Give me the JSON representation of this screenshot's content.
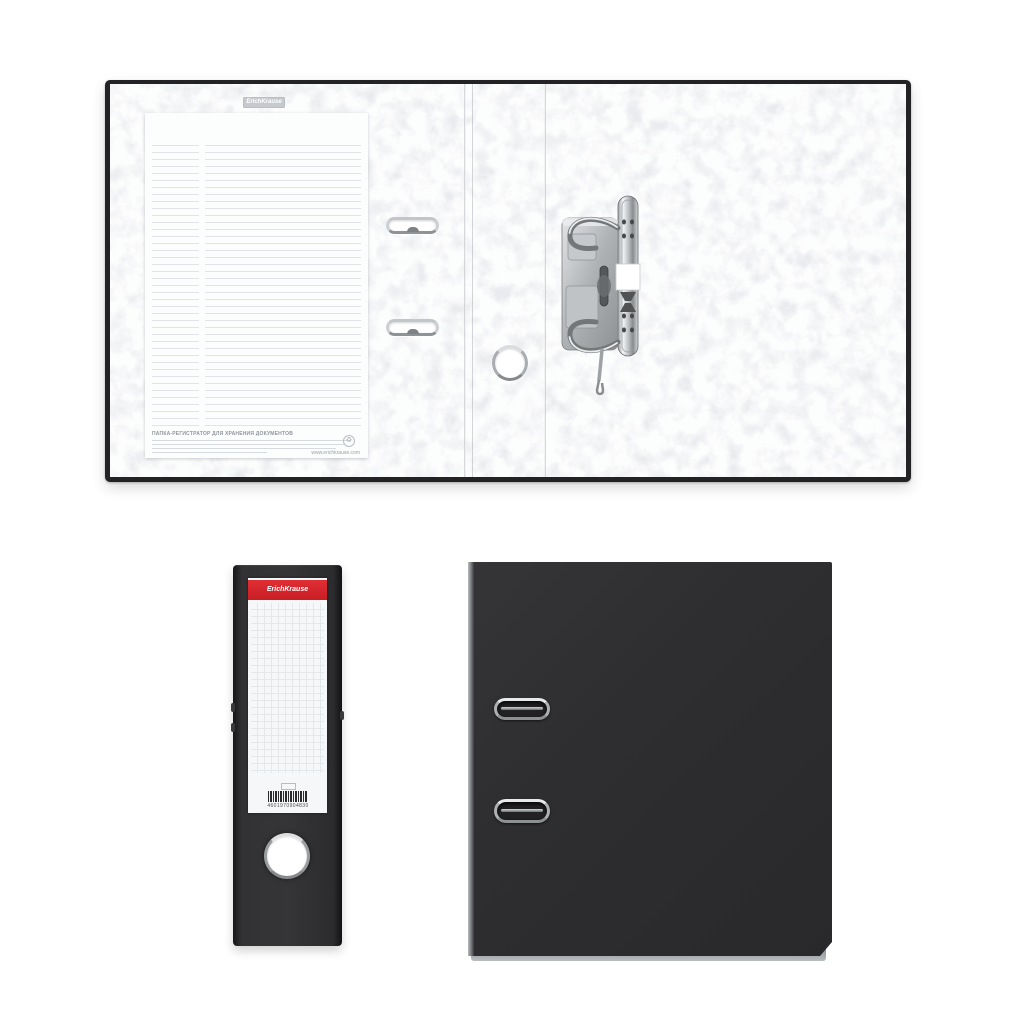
{
  "page": {
    "background": "#ffffff"
  },
  "brand": {
    "name": "ErichKrause",
    "accent_red": "#d6212b"
  },
  "colors": {
    "binder_black": "#2c2c2e",
    "marble_paper": "#e9ebee",
    "chrome_metal": "#c6c9cd",
    "label_white": "#f6f7f8"
  },
  "icons": {
    "recycle": "♻"
  },
  "open_binder": {
    "emboss_stamp": "ErichKrause",
    "sheet": {
      "heading": "ПАПКА-РЕГИСТРАТОР ДЛЯ ХРАНЕНИЯ ДОКУМЕНТОВ",
      "website": "www.erichkrause.com"
    }
  },
  "spine": {
    "label_brand": "ErichKrause",
    "barcode_digits": "4601970904830"
  }
}
